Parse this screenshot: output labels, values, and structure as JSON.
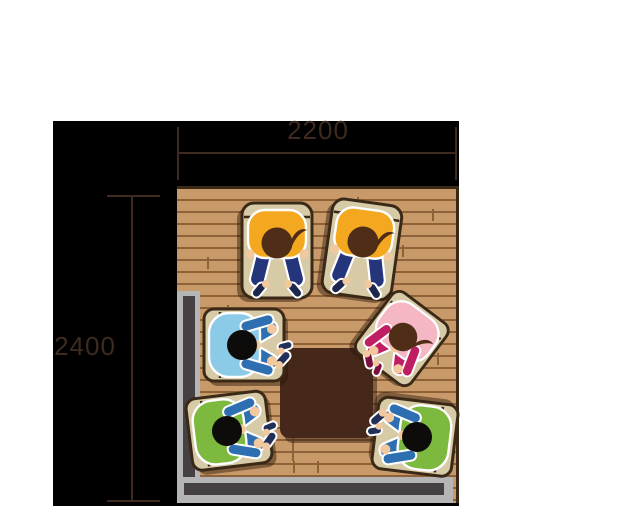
{
  "diagram": {
    "type": "floor-plan-top-view",
    "description": "Overhead illustration of six people seated on cushions around a low square table in a 2200 x 2400 mm sunken seating area with an L-shaped step",
    "dimensions": {
      "width_mm": "2200",
      "depth_mm": "2400"
    },
    "colors": {
      "canvas": "#000000",
      "floor": "#c89a6a",
      "plankLine": "#8f6138",
      "wallLight": "#b5b5b6",
      "wallDark": "#454142",
      "table": "#46281a",
      "cushion": "#d7caa7",
      "cushionBorder": "#3b2917",
      "outline": "#ffffff",
      "skin": "#f2c89e",
      "dim": "#3e2a1f",
      "shadow": "rgba(40,20,6,0.45)"
    },
    "table": {
      "shape": "square",
      "seats": 6
    },
    "people": [
      {
        "id": "person-yellow-left",
        "archetype": "kneel",
        "x": 277,
        "y": 243,
        "rot": 90,
        "scale": 1,
        "shirt": "#f4a81f",
        "limbs": "#25357c",
        "shoe": "#1c2750",
        "head": "#4f2d16",
        "hair": true
      },
      {
        "id": "person-yellow-right",
        "archetype": "kneel",
        "x": 363,
        "y": 242,
        "rot": 98,
        "scale": 1,
        "shirt": "#f4a81f",
        "limbs": "#25357c",
        "shoe": "#1c2750",
        "head": "#4f2d16",
        "hair": true
      },
      {
        "id": "person-blue",
        "archetype": "cross",
        "x": 242,
        "y": 345,
        "rot": 0,
        "scale": 1,
        "shirt": "#8ccbe8",
        "limbs": "#2e6fb2",
        "shoe": "#203058",
        "head": "#0e0c0b",
        "hair": false
      },
      {
        "id": "person-pink",
        "archetype": "cross",
        "x": 403,
        "y": 337,
        "rot": 127,
        "scale": 0.95,
        "shirt": "#f5b7c3",
        "limbs": "#c01e63",
        "shoe": "#7e1040",
        "head": "#4f2d16",
        "hair": true
      },
      {
        "id": "person-green-left",
        "archetype": "cross",
        "x": 227,
        "y": 431,
        "rot": -7,
        "scale": 1,
        "shirt": "#7db93e",
        "limbs": "#2e6fb2",
        "shoe": "#203058",
        "head": "#0e0c0b",
        "hair": false
      },
      {
        "id": "person-green-right",
        "archetype": "cross",
        "x": 417,
        "y": 437,
        "rot": 187,
        "scale": 1,
        "shirt": "#7db93e",
        "limbs": "#2e6fb2",
        "shoe": "#203058",
        "head": "#0e0c0b",
        "hair": false
      }
    ],
    "floor_seams": [
      [
        93,
        152
      ],
      [
        115,
        248
      ],
      [
        115,
        260
      ],
      [
        116,
        272
      ],
      [
        140,
        272
      ],
      [
        30,
        68
      ],
      [
        255,
        20
      ],
      [
        260,
        164
      ],
      [
        70,
        32
      ],
      [
        180,
        8
      ],
      [
        50,
        116
      ],
      [
        225,
        56
      ],
      [
        20,
        200
      ]
    ]
  }
}
